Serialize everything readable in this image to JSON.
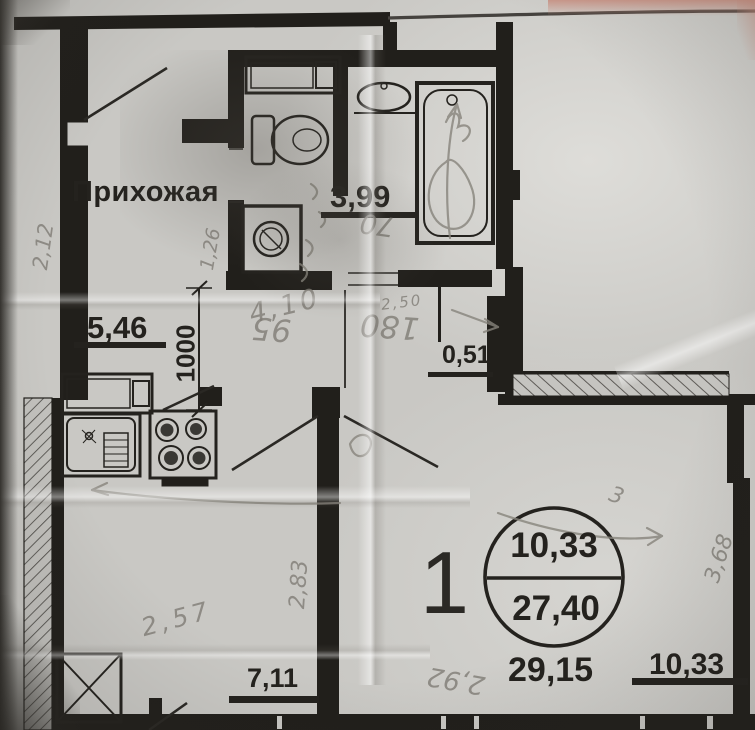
{
  "plan": {
    "rooms": {
      "hallway": {
        "label": "Прихожая"
      },
      "bathroom": {
        "area": "3,99"
      },
      "kitchen": {
        "width": "5,46",
        "depth_mm": "1000"
      },
      "niche": {
        "area": "0,51"
      },
      "lower_room": {
        "area": "7,11"
      }
    },
    "stamp": {
      "apartment_number": "1",
      "living_area": "10,33",
      "total_area": "27,40"
    },
    "totals": {
      "overall": "29,15",
      "room": "10,33"
    },
    "handwritten": {
      "left_wall": "2,12",
      "hall_bath_wall": "1,26",
      "below_bath": "70",
      "corridor": "4,10",
      "bath_width": "2,50",
      "mid_left": "95",
      "mid_right": "180",
      "inner_wall": "2,83",
      "room_width": "2,57",
      "bottom_note": "2,92",
      "right_wall": "3,68",
      "scribble": "3"
    },
    "colors": {
      "paper": "#c9c8c4",
      "ink": "#211f1c",
      "pencil": "#84817b",
      "photo_edge": "#36332f",
      "pink_edge": "#c98e7f"
    }
  }
}
